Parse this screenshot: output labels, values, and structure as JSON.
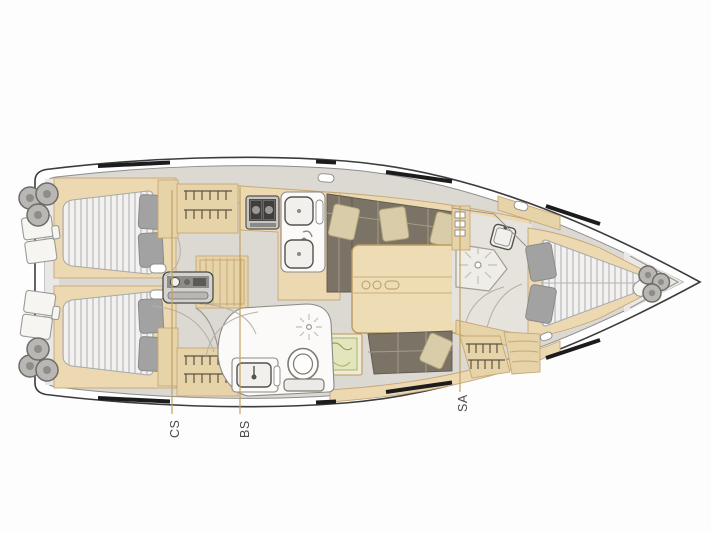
{
  "labels": [
    {
      "id": "cs",
      "text": "CS"
    },
    {
      "id": "bs",
      "text": "BS"
    },
    {
      "id": "sa",
      "text": "SA"
    }
  ],
  "colors": {
    "hull_outline": "#3c3c3c",
    "deck_gray": "#e9e8e6",
    "floor_gray": "#dcd8d2",
    "wood_light": "#ecd9b2",
    "wood_mid": "#e7d3a8",
    "wood_edge": "#c5a878",
    "settee_upholstery": "#7b7366",
    "settee_pillow": "#d9cda9",
    "bed_pillow": "#a2a2a2",
    "mattress_stripe": "#c7c7c7",
    "chart_map": "#e3e6bc",
    "hull_window": "#1c1c1c",
    "leader_line": "#c2a35e",
    "label_text": "#4b4b4b"
  },
  "areas": [
    "stern-swim-platform",
    "aft-cabin-port",
    "aft-cabin-starboard",
    "companionway-steps",
    "engine-compartment",
    "galley",
    "aft-head",
    "salon-settee",
    "salon-table",
    "navigation-station",
    "forward-head-shower",
    "forward-cabin-v-berth",
    "bow-anchor-locker"
  ]
}
